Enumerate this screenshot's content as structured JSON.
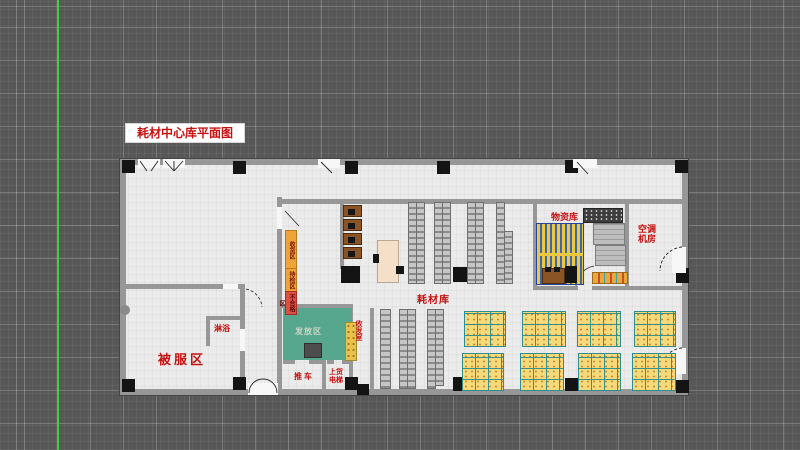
{
  "title": "耗材中心库平面图",
  "colors": {
    "canvas_bg": "#575757",
    "grid_line": "#8f8f8f",
    "axis_green": "#3fd23f",
    "floor": "#ebebeb",
    "wall": "#979797",
    "column": "#141414",
    "label_red": "#c41210",
    "teal_room": "#57a78e",
    "pallet_yellow": "#f4da7a",
    "pallet_grid_teal": "#2e8c8c",
    "rack_gray": "#bdbdbd",
    "sign_orange": "#efa43a",
    "sign_red": "#dd5044",
    "desk_brown": "#8a5426",
    "shelf_stripe_blue": "#3b66b8",
    "shelf_stripe_yellow": "#ecc83e"
  },
  "labels": {
    "linen_area": "被服区",
    "shower": "淋浴",
    "consumables_store": "耗材库",
    "materials_store": "物资库",
    "hvac_line1": "空调",
    "hvac_line2": "机房",
    "dispatch_area": "发放区",
    "trolley": "推车",
    "lift_line1": "上货",
    "lift_line2": "电梯",
    "mail_room": "收发室"
  },
  "signs": [
    {
      "text": "收货区",
      "type": "orange"
    },
    {
      "text": "待检区",
      "type": "orange"
    },
    {
      "text": "不合格区",
      "type": "red"
    }
  ]
}
